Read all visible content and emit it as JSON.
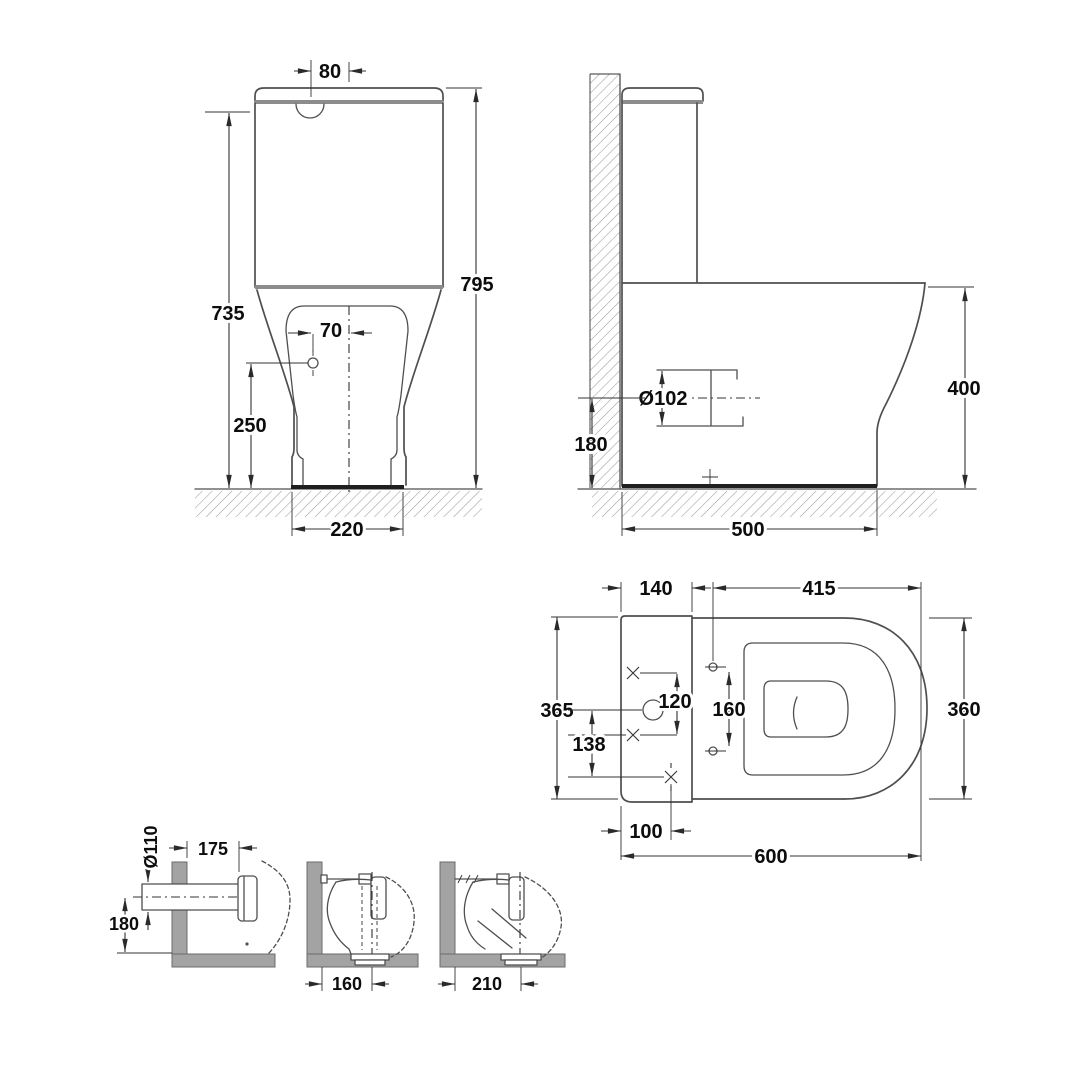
{
  "colors": {
    "background": "#ffffff",
    "line": "#4f4f4f",
    "dark": "#1f1f1f",
    "seam": "#8c8c8c",
    "dim": "#333333",
    "wall_fill": "#a3a3a3",
    "hatch": "#9c9c9c",
    "text": "#0d0d0d"
  },
  "front_view": {
    "button_width": "80",
    "overall_height": "795",
    "cistern_height": "735",
    "inlet_offset": "70",
    "inlet_height": "250",
    "base_width": "220"
  },
  "side_view": {
    "outlet_diameter": "Ø102",
    "outlet_height": "180",
    "pan_height": "400",
    "base_depth": "500"
  },
  "plan_view": {
    "cistern_depth": "140",
    "seat_length": "415",
    "overall_width": "365",
    "fixing_centres": "120",
    "hinge_centres": "160",
    "inlet_to_outlet": "138",
    "pan_width": "360",
    "outlet_offset": "100",
    "overall_depth": "600"
  },
  "installation": {
    "p_trap": {
      "pipe_diameter": "Ø110",
      "wall_projection": "175",
      "centre_height": "180"
    },
    "s_trap_near": {
      "outlet_distance": "160"
    },
    "s_trap_far": {
      "outlet_distance": "210"
    }
  }
}
